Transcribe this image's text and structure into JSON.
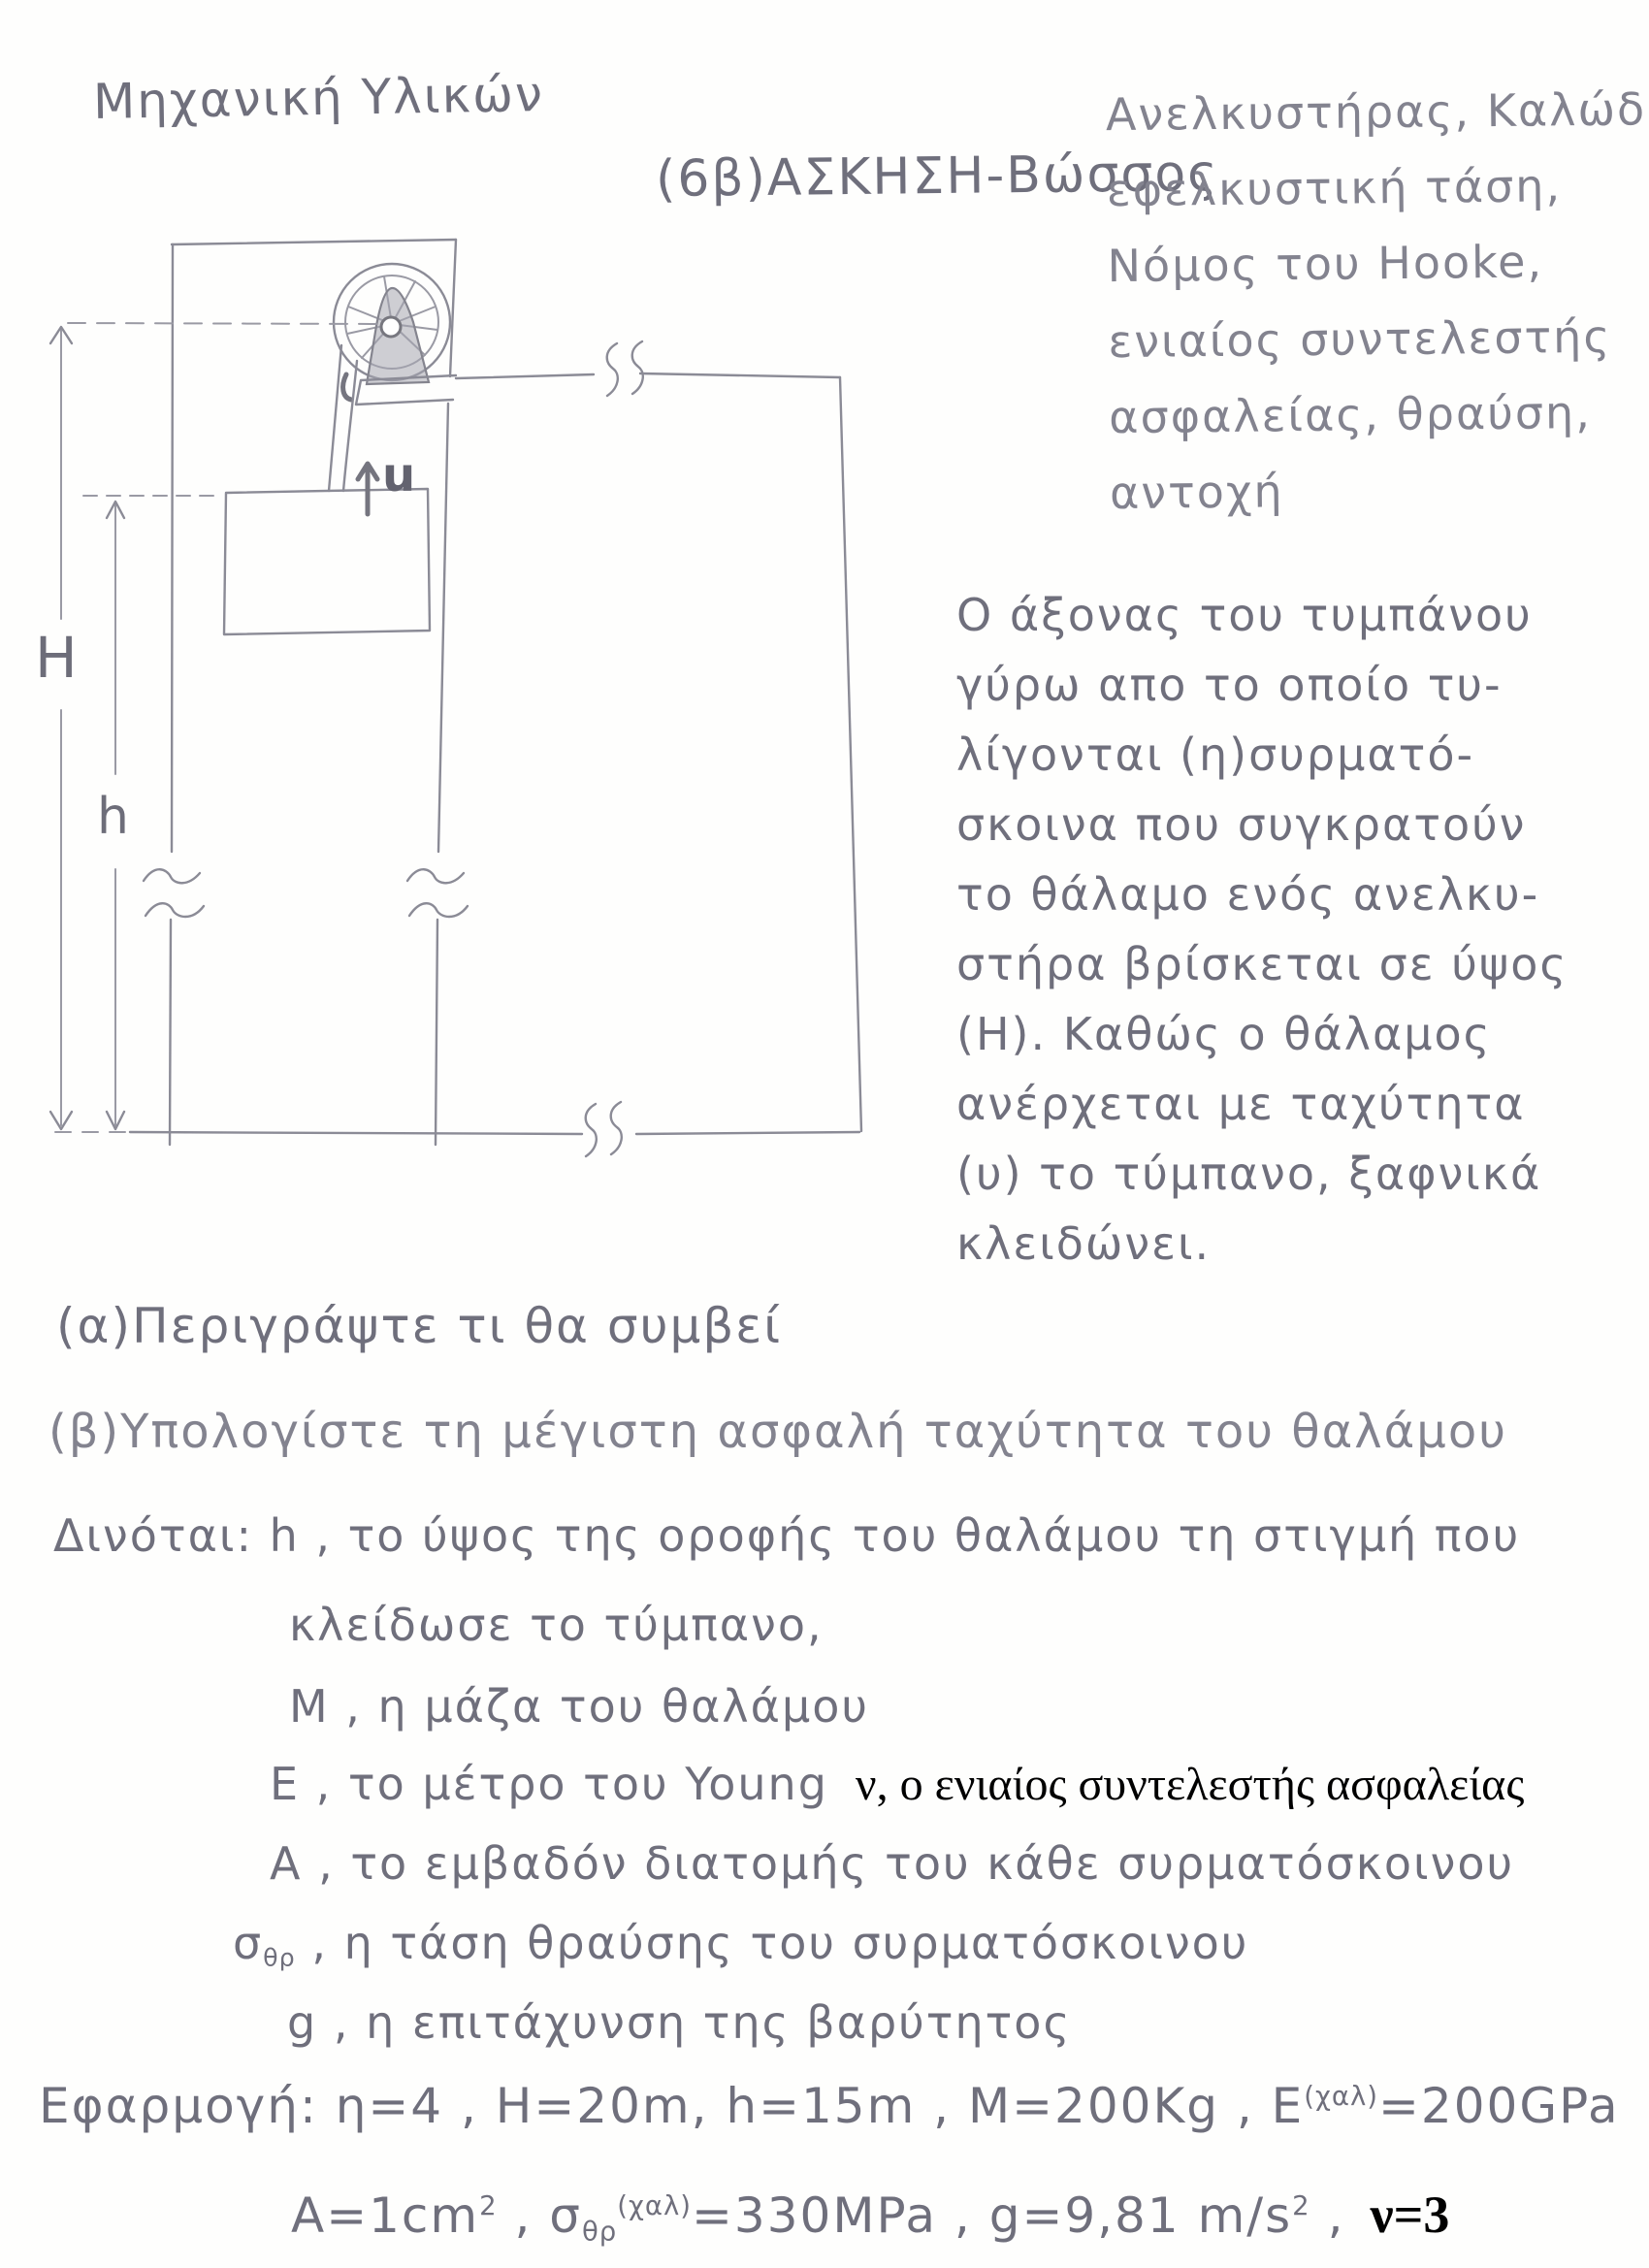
{
  "header": {
    "course": "Μηχανική Υλικών",
    "exercise": "(6β)ΑΣΚΗΣΗ-Βώσσος"
  },
  "keywords": {
    "lines": [
      "Ανελκυστήρας, Καλώδιο",
      "εφελκυστική τάση,",
      "Νόμος του Hooke,",
      "ενιαίος συντελεστής",
      "ασφαλείας, θραύση,",
      "αντοχή"
    ]
  },
  "description": {
    "lines": [
      "Ο άξονας του τυμπάνου",
      "γύρω απο το οποίο τυ-",
      "λίγονται (η)συρματό-",
      "σκοινα που συγκρατούν",
      "το θάλαμο ενός ανελκυ-",
      "στήρα βρίσκεται σε ύψος",
      "(Η). Καθώς ο θάλαμος",
      "ανέρχεται με ταχύτητα",
      "(υ) το τύμπανο, ξαφνικά",
      "κλειδώνει."
    ]
  },
  "questions": {
    "a": "(α)Περιγράψτε τι θα συμβεί",
    "b": "(β)Υπολογίστε τη μέγιστη ασφαλή ταχύτητα του θαλάμου"
  },
  "given": {
    "line1": "Δινόται: h , το ύψος της οροφής του θαλάμου τη στιγμή που",
    "line2": "κλείδωσε το τύμπανο,",
    "m_line": "Μ , η μάζα του θαλάμου",
    "e_line": "Ε , το μέτρο του Young",
    "e_typed": "ν, ο ενιαίος συντελεστής ασφαλείας",
    "a_line": "Α , το εμβαδόν διατομής του κάθε συρματόσκοινου",
    "sigma": "σ",
    "sigma_sub": "θρ",
    "sigma_rest": " , η τάση θραύσης του συρματόσκοινου",
    "g_line": "g , η επιτάχυνση της βαρύτητος"
  },
  "application": {
    "p1": "Εφαρμογή: η=4 , Η=20m, h=15m , Μ=200Kg , Ε",
    "p1_sup": "(χαλ)",
    "p2": "=200GPa",
    "q1": "Α=1cm",
    "q1_sup": "2",
    "q2": " , σ",
    "q2_sub": "θρ",
    "q2_sup": "(χαλ)",
    "q3": "=330MPa , g=9,81 m∕s",
    "q3_sup": "2",
    "q4": " ,",
    "nu_typed": "ν=3"
  },
  "diagram": {
    "label_H": "H",
    "label_h": "h",
    "label_u": "u"
  },
  "colors": {
    "pencil": "#8b8b96",
    "typed_ink": "#000000",
    "paper": "#fefefd"
  }
}
